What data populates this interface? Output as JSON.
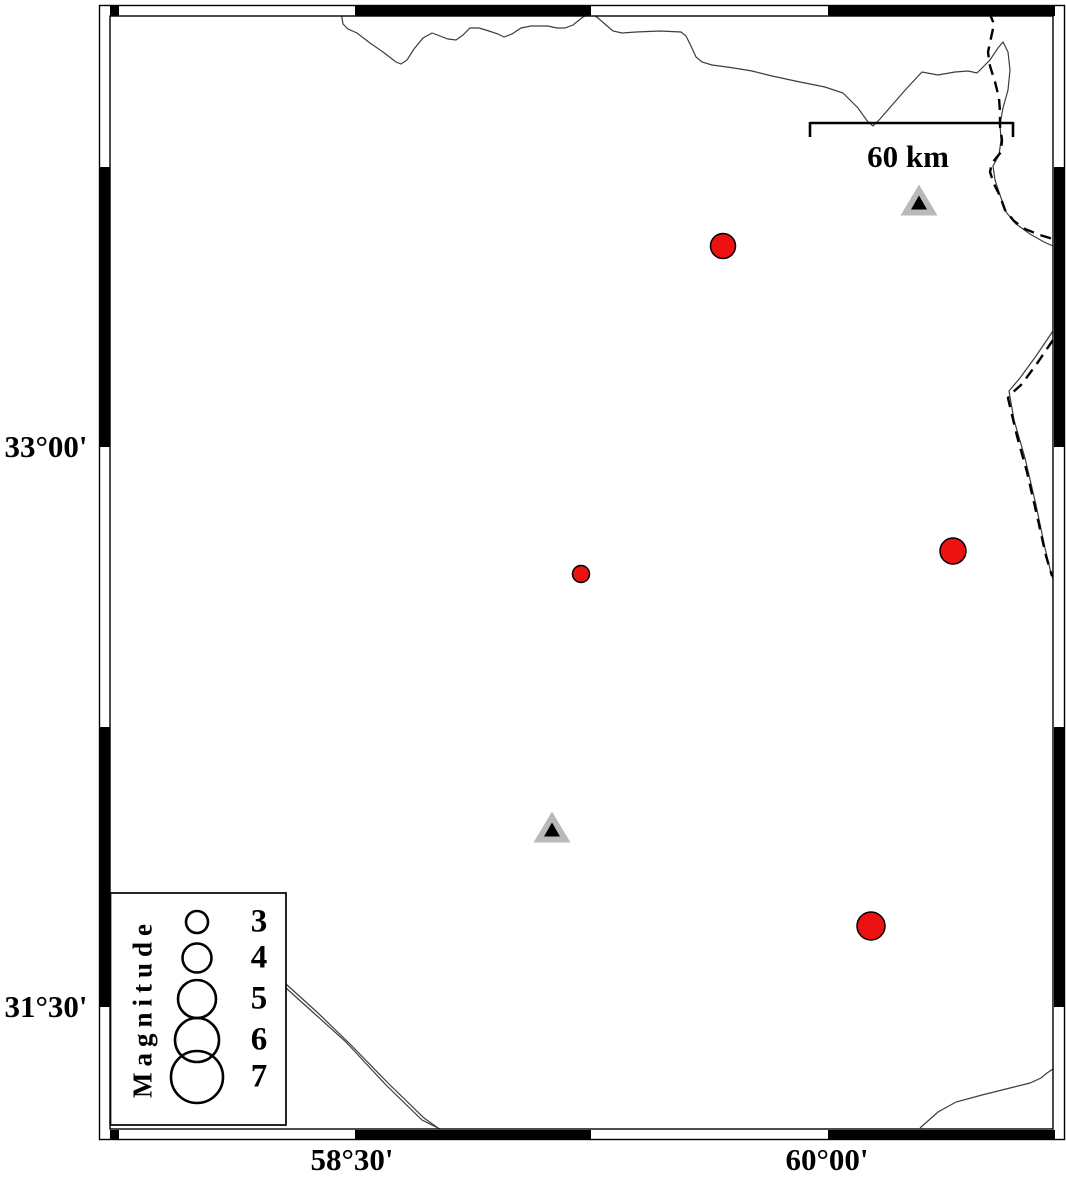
{
  "figure": {
    "title": "seismicity-map",
    "background_color": "#ffffff",
    "frame_color": "#000000"
  },
  "axis": {
    "left_labels": [
      {
        "text": "33°00'",
        "y": 447
      },
      {
        "text": "31°30'",
        "y": 1007
      }
    ],
    "bottom_labels": [
      {
        "text": "58°30'",
        "x": 352
      },
      {
        "text": "60°00'",
        "x": 827
      }
    ]
  },
  "scale_bar": {
    "label": "60 km",
    "x1": 810,
    "x2": 1013,
    "y": 123,
    "tick_drop": 14
  },
  "legend": {
    "title": "Magnitude",
    "circle_x": 197,
    "label_x": 259,
    "entries": [
      {
        "magnitude": "3",
        "diameter": 22,
        "y": 922
      },
      {
        "magnitude": "4",
        "diameter": 29,
        "y": 958
      },
      {
        "magnitude": "5",
        "diameter": 38,
        "y": 999
      },
      {
        "magnitude": "6",
        "diameter": 44,
        "y": 1040
      },
      {
        "magnitude": "7",
        "diameter": 52,
        "y": 1077
      }
    ]
  },
  "markers": {
    "earthquake_color": "#ee1111",
    "station_fill": "#b9b9b9",
    "station_inner": "#000000",
    "earthquakes": [
      {
        "x": 723,
        "y": 246,
        "d": 25
      },
      {
        "x": 581,
        "y": 574,
        "d": 17
      },
      {
        "x": 953,
        "y": 551,
        "d": 26
      },
      {
        "x": 871,
        "y": 926,
        "d": 28
      }
    ],
    "stations": [
      {
        "x": 919,
        "y": 200
      },
      {
        "x": 552,
        "y": 827
      }
    ]
  }
}
